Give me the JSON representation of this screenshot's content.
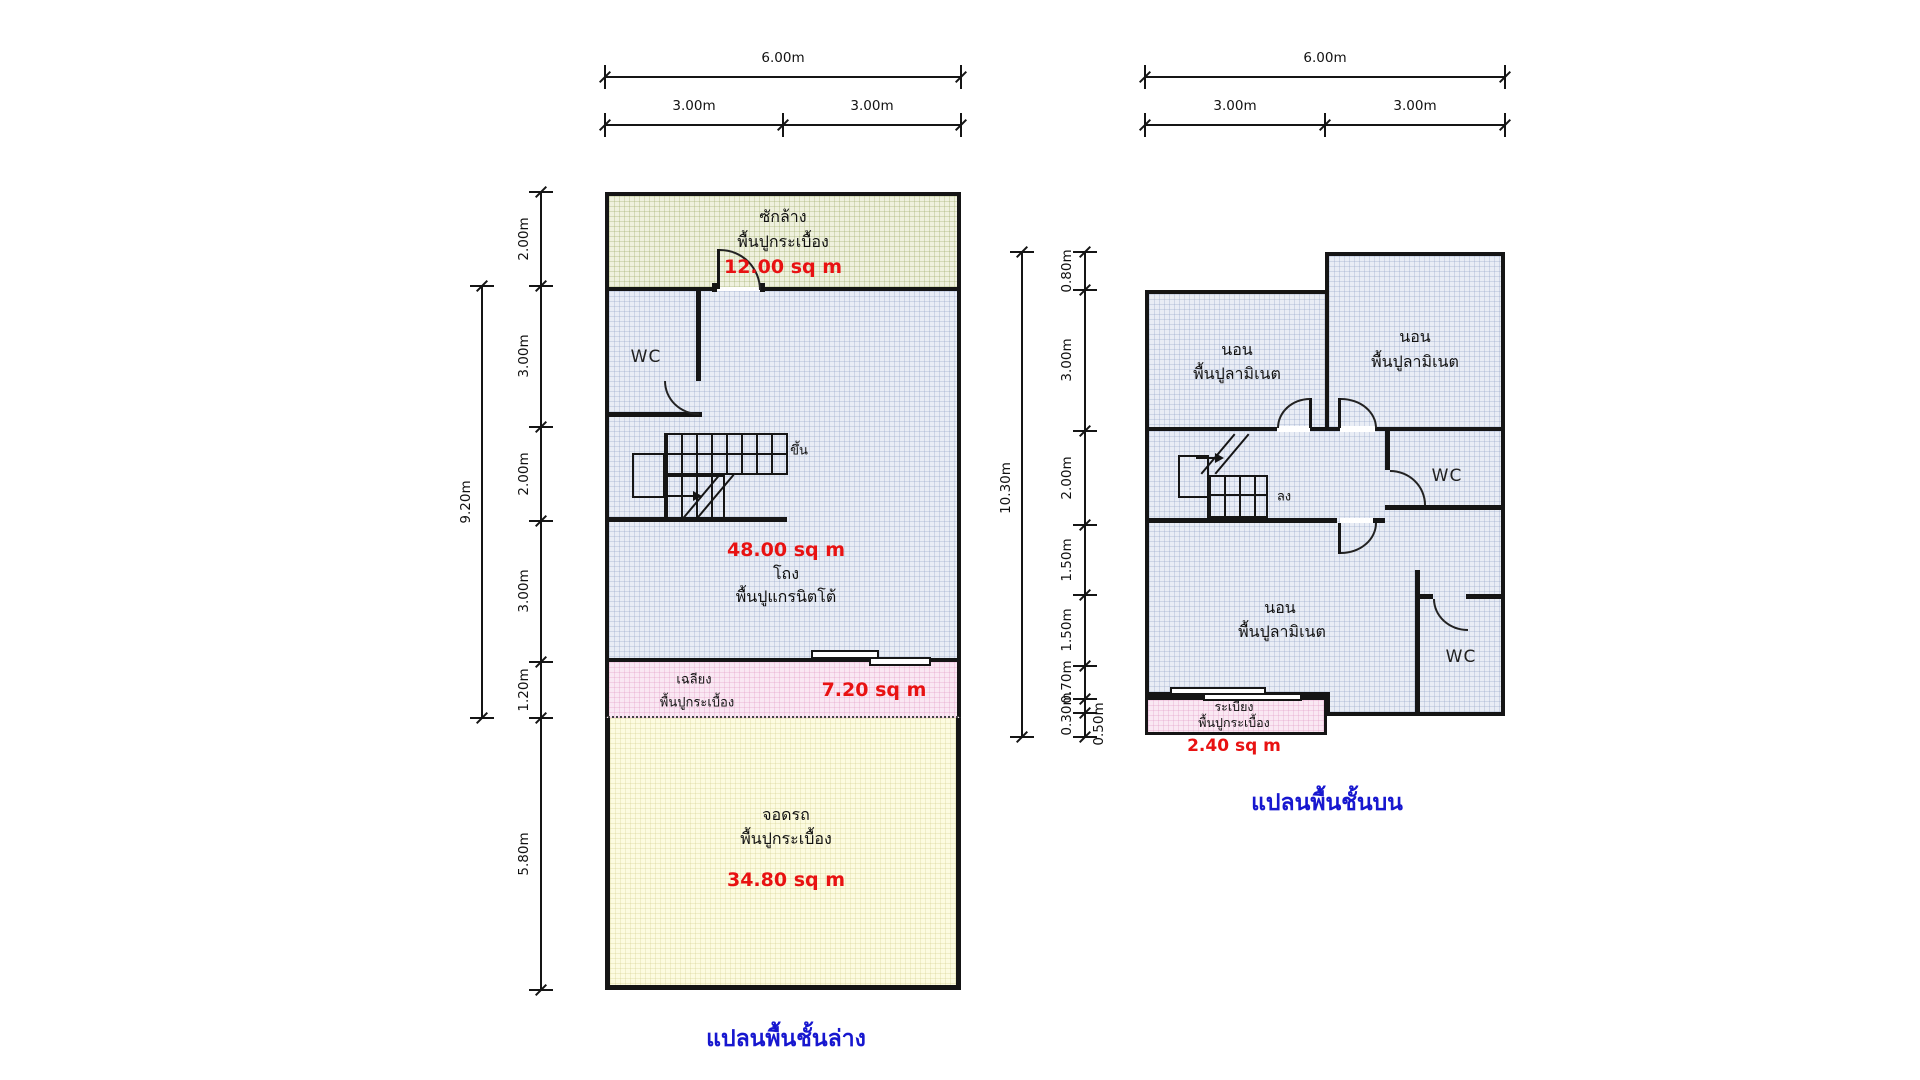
{
  "lower": {
    "caption": "แปลนพื้นชั้นล่าง",
    "dims": {
      "total_width": "6.00m",
      "width_left": "3.00m",
      "width_right": "3.00m",
      "left": [
        "2.00m",
        "3.00m",
        "2.00m",
        "3.00m",
        "1.20m",
        "5.80m"
      ],
      "overall_height": "9.20m"
    },
    "rooms": {
      "laundry": {
        "name": "ซักล้าง",
        "floor": "พื้นปูกระเบื้อง",
        "area": "12.00 sq m"
      },
      "wc": {
        "label": "WC"
      },
      "stairs": {
        "direction": "ขึ้น"
      },
      "hall": {
        "area": "48.00 sq m",
        "name": "โถง",
        "floor": "พื้นปูแกรนิตโต้"
      },
      "porch": {
        "name": "เฉลียง",
        "floor": "พื้นปูกระเบื้อง",
        "area": "7.20 sq m"
      },
      "carport": {
        "name": "จอดรถ",
        "floor": "พื้นปูกระเบื้อง",
        "area": "34.80 sq m"
      }
    }
  },
  "upper": {
    "caption": "แปลนพื้นชั้นบน",
    "dims": {
      "total_width": "6.00m",
      "width_left": "3.00m",
      "width_right": "3.00m",
      "left": [
        "0.80m",
        "3.00m",
        "2.00m",
        "1.50m",
        "1.50m",
        "0.70m",
        "0.30m",
        "0.50m"
      ],
      "overall_height": "10.30m"
    },
    "rooms": {
      "bedroom_top_left": {
        "name": "นอน",
        "floor": "พื้นปูลามิเนต"
      },
      "bedroom_top_right": {
        "name": "นอน",
        "floor": "พื้นปูลามิเนต"
      },
      "wc_top": {
        "label": "WC"
      },
      "stairs": {
        "direction": "ลง"
      },
      "hall_area": "56.10 sq m",
      "bedroom_bottom": {
        "name": "นอน",
        "floor": "พื้นปูลามิเนต"
      },
      "wc_bottom": {
        "label": "WC"
      },
      "balcony": {
        "name": "ระเบียง",
        "floor": "พื้นปูกระเบื้อง",
        "area": "2.40 sq m"
      }
    }
  }
}
